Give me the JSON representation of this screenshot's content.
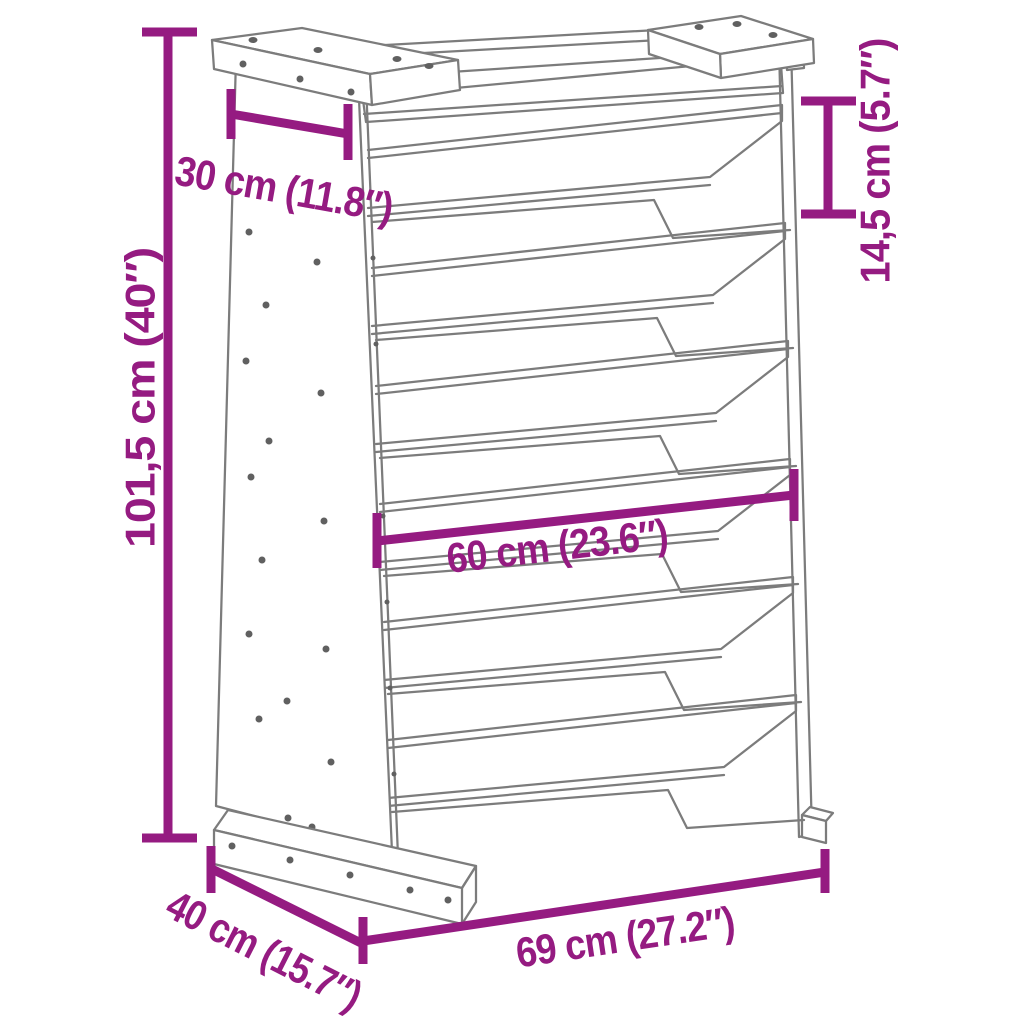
{
  "figure": {
    "description": "Technical line drawing of a 6-tier slanted vertical herb planter with magenta dimension annotations"
  },
  "colors": {
    "dimension_annotation": "#951b81",
    "line_art": "#7c7c7c",
    "screw": "#606060",
    "background": "#ffffff"
  },
  "dimensions": {
    "overall_height": {
      "label": "101,5 cm (40″)",
      "cm": "101,5",
      "inches": "40"
    },
    "top_depth": {
      "label": "30 cm (11.8″)",
      "cm": "30",
      "inches": "11.8"
    },
    "tier_spacing": {
      "label": "14,5 cm (5.7″)",
      "cm": "14,5",
      "inches": "5.7"
    },
    "inner_width": {
      "label": "60 cm (23.6″)",
      "cm": "60",
      "inches": "23.6"
    },
    "base_depth": {
      "label": "40 cm (15.7″)",
      "cm": "40",
      "inches": "15.7"
    },
    "overall_width": {
      "label": "69 cm (27.2″)",
      "cm": "69",
      "inches": "27.2"
    }
  }
}
